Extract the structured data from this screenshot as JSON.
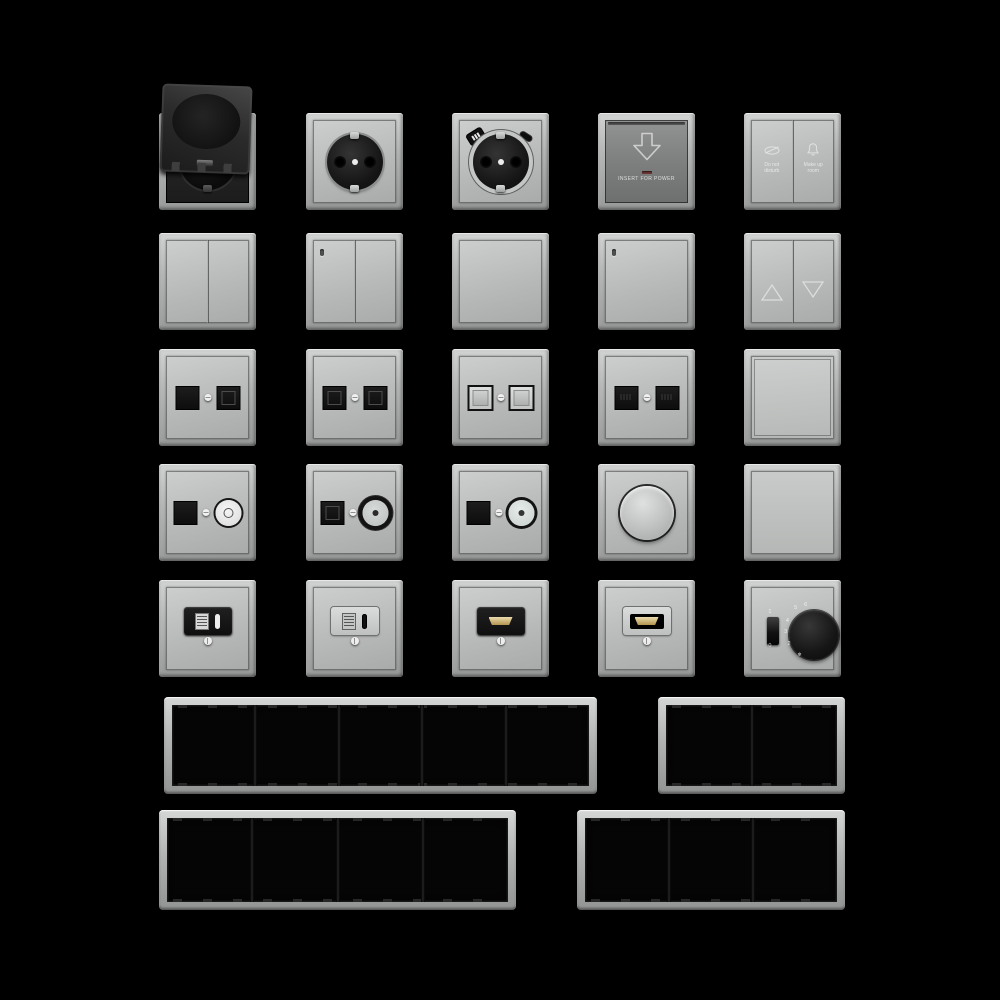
{
  "scene": {
    "description": "Catalog sheet of flush-mounted electrical switch-range components in aluminium grey on black background",
    "background_color": "#000000"
  },
  "colors": {
    "frame_grey": "#b4b6b5",
    "plate_grey": "#bdbfbe",
    "keycard_plate_grey": "#7c7e7d",
    "socket_black": "#161616",
    "led_red": "#6d3531",
    "hdmi_gold": "#c9a95f",
    "etched_label": "#ececec"
  },
  "labels": {
    "card_switch": "INSERT FOR POWER",
    "dnd_line1": "Do not",
    "dnd_line2": "disturb",
    "mur_line1": "Make up",
    "mur_line2": "room"
  },
  "thermostat": {
    "on": "1",
    "off": "0",
    "ticks": [
      "2",
      "3",
      "4",
      "5",
      "6"
    ],
    "frost": "❄"
  },
  "products": {
    "row1": [
      "schuko-socket-with-hinged-lid",
      "schuko-socket",
      "schuko-socket-with-usb-a-and-usb-c",
      "keycard-power-switch",
      "hotel-service-double-switch"
    ],
    "row2": [
      "double-rocker-switch",
      "double-rocker-switch-with-indicator",
      "single-rocker-switch",
      "single-rocker-switch-with-indicator",
      "shutter-rocker-switch-up-down"
    ],
    "row3": [
      "dual-data-socket-black",
      "dual-data-socket-black-framed",
      "dual-data-socket-shuttered-grey",
      "dual-data-socket-black-pinned",
      "single-rocker-flat"
    ],
    "row4": [
      "data-plus-coax-socket-white-barrel",
      "data-plus-coax-socket-black-ring",
      "data-plus-coax-socket-black-ring-light",
      "rotary-dimmer",
      "blank-cover-plate"
    ],
    "row5": [
      "usb-a-c-charging-socket-black",
      "usb-a-c-charging-socket-grey",
      "hdmi-socket-black",
      "hdmi-socket-grey",
      "room-thermostat-with-switch"
    ]
  },
  "frames": [
    {
      "name": "frame-5-gang",
      "gangs": 5
    },
    {
      "name": "frame-2-gang",
      "gangs": 2
    },
    {
      "name": "frame-4-gang",
      "gangs": 4
    },
    {
      "name": "frame-3-gang",
      "gangs": 3
    }
  ]
}
